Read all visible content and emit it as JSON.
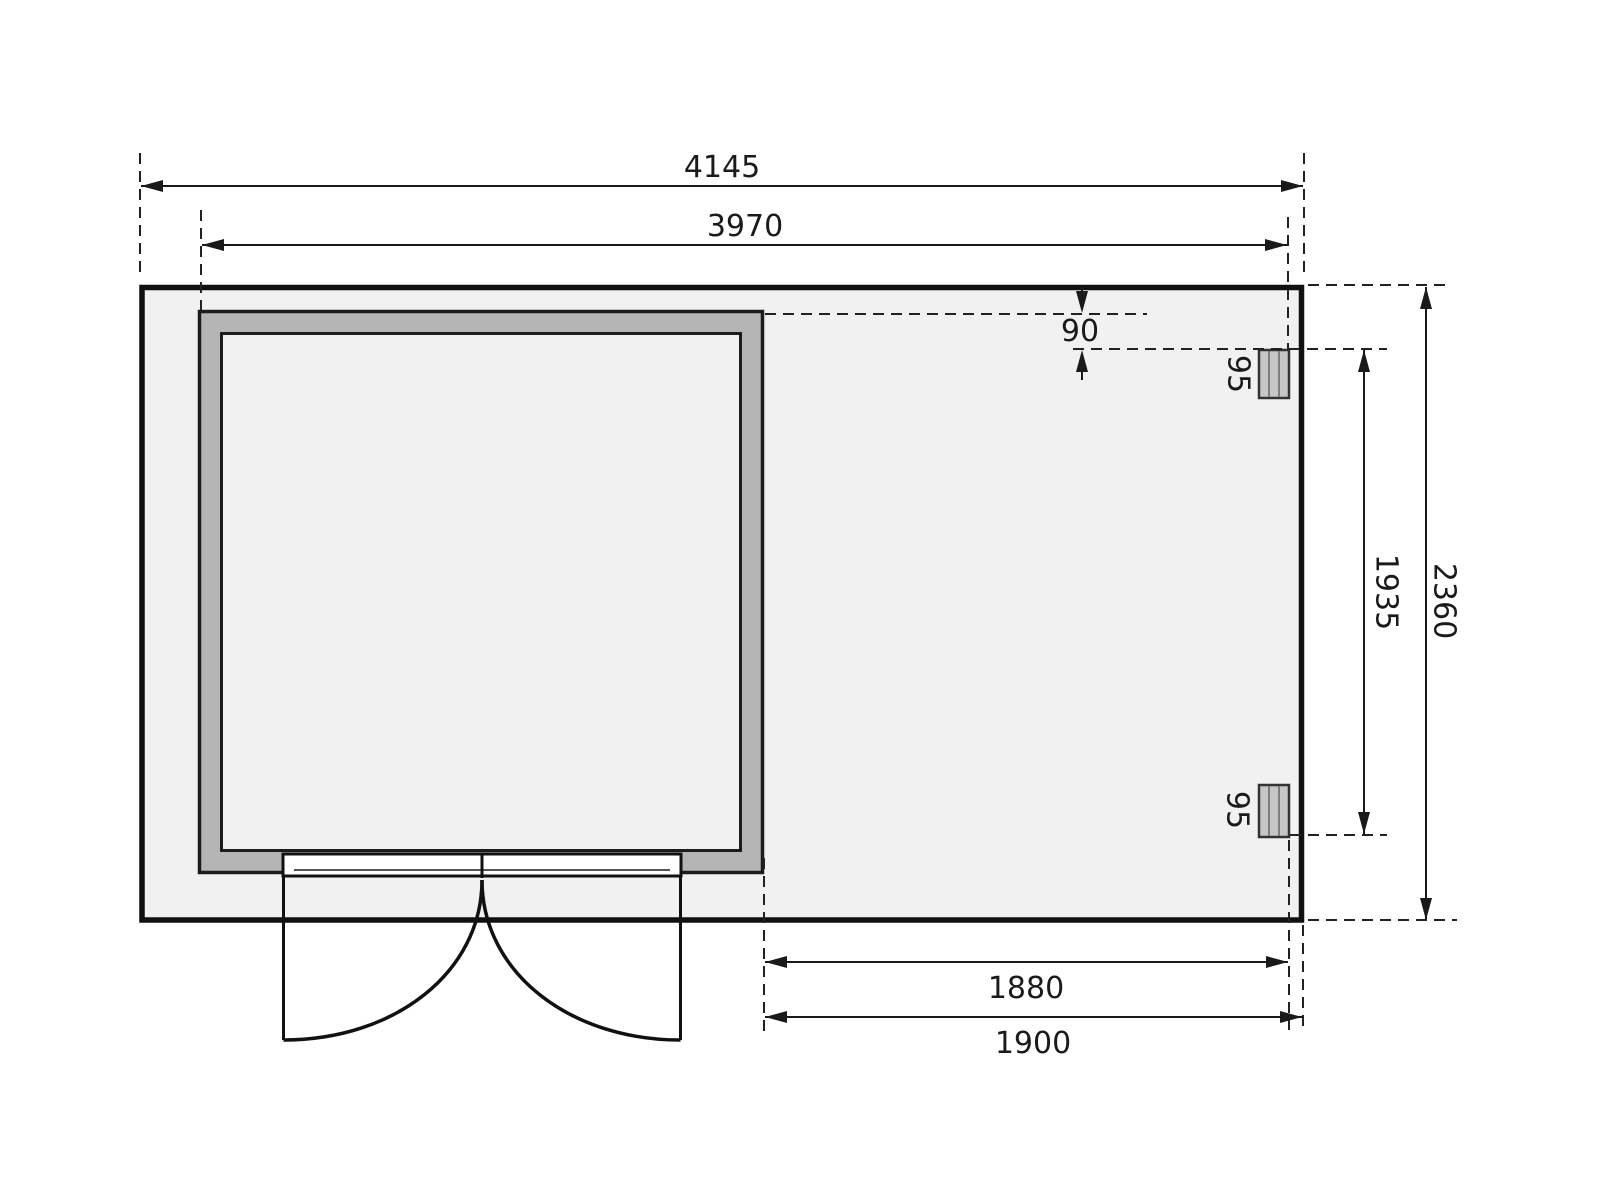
{
  "drawing": {
    "dimensions": {
      "total_width": "4145",
      "inner_width": "3970",
      "total_depth": "2360",
      "post_span": "1935",
      "back_offset": "90",
      "post_width_top": "95",
      "post_width_bottom": "95",
      "annex_inner_width": "1880",
      "annex_outer_width": "1900"
    },
    "colors": {
      "background": "#ffffff",
      "floor": "#f1f1f1",
      "wall": "#b4b4b4",
      "post": "#c6c6c6",
      "line": "#1a1a1a"
    }
  }
}
